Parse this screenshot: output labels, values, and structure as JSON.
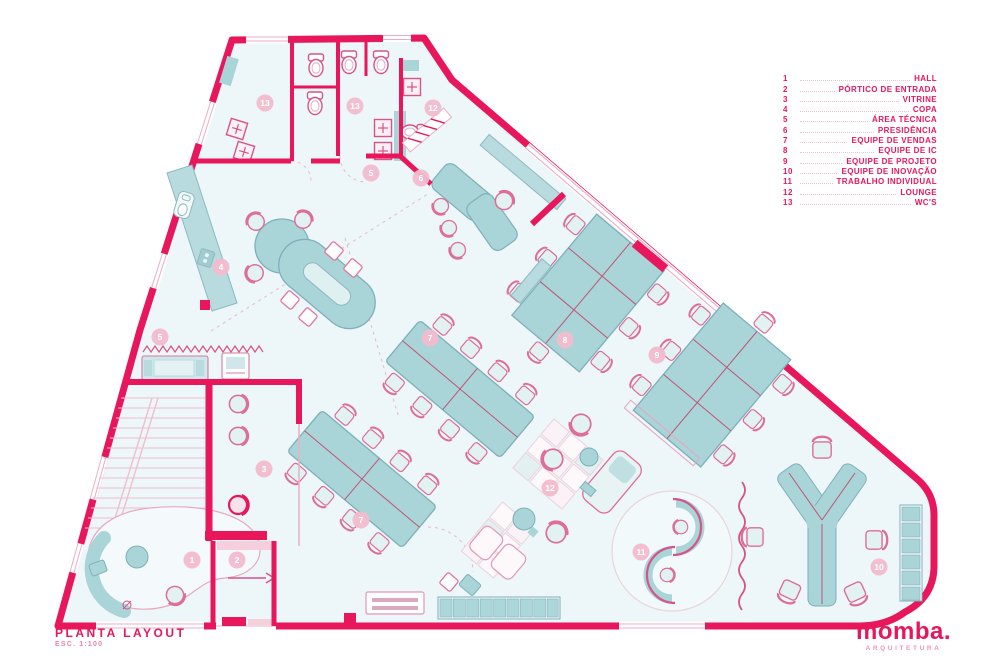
{
  "legend": {
    "items": [
      {
        "num": "1",
        "label": "HALL"
      },
      {
        "num": "2",
        "label": "PÓRTICO DE ENTRADA"
      },
      {
        "num": "3",
        "label": "VITRINE"
      },
      {
        "num": "4",
        "label": "COPA"
      },
      {
        "num": "5",
        "label": "ÁREA TÉCNICA"
      },
      {
        "num": "6",
        "label": "PRESIDÊNCIA"
      },
      {
        "num": "7",
        "label": "EQUIPE DE VENDAS"
      },
      {
        "num": "8",
        "label": "EQUIPE DE IC"
      },
      {
        "num": "9",
        "label": "EQUIPE DE PROJETO"
      },
      {
        "num": "10",
        "label": "EQUIPE DE INOVAÇÃO"
      },
      {
        "num": "11",
        "label": "TRABALHO INDIVIDUAL"
      },
      {
        "num": "12",
        "label": "LOUNGE"
      },
      {
        "num": "13",
        "label": "WC'S"
      }
    ]
  },
  "title_block": {
    "title": "PLANTA LAYOUT",
    "scale": "ESC. 1:100"
  },
  "logo": {
    "name": "momba.",
    "tagline": "ARQUITETURA"
  },
  "plan": {
    "badges": [
      {
        "n": "1",
        "x": 192,
        "y": 560
      },
      {
        "n": "2",
        "x": 237,
        "y": 560
      },
      {
        "n": "3",
        "x": 264,
        "y": 469
      },
      {
        "n": "4",
        "x": 221,
        "y": 267
      },
      {
        "n": "5",
        "x": 160,
        "y": 337
      },
      {
        "n": "5",
        "x": 371,
        "y": 173
      },
      {
        "n": "6",
        "x": 421,
        "y": 178
      },
      {
        "n": "7",
        "x": 430,
        "y": 338
      },
      {
        "n": "7",
        "x": 361,
        "y": 520
      },
      {
        "n": "8",
        "x": 565,
        "y": 340
      },
      {
        "n": "9",
        "x": 657,
        "y": 355
      },
      {
        "n": "10",
        "x": 879,
        "y": 567
      },
      {
        "n": "11",
        "x": 641,
        "y": 552
      },
      {
        "n": "12",
        "x": 550,
        "y": 488
      },
      {
        "n": "12",
        "x": 433,
        "y": 108
      },
      {
        "n": "13",
        "x": 265,
        "y": 103
      },
      {
        "n": "13",
        "x": 355,
        "y": 106
      }
    ],
    "colors": {
      "wall": "#e8175c",
      "floor": "#edf6f8",
      "furniture": "#a9d4d8",
      "badge": "#f2bccd",
      "badge_text": "#ffffff",
      "line_pink": "#d7548a"
    }
  }
}
